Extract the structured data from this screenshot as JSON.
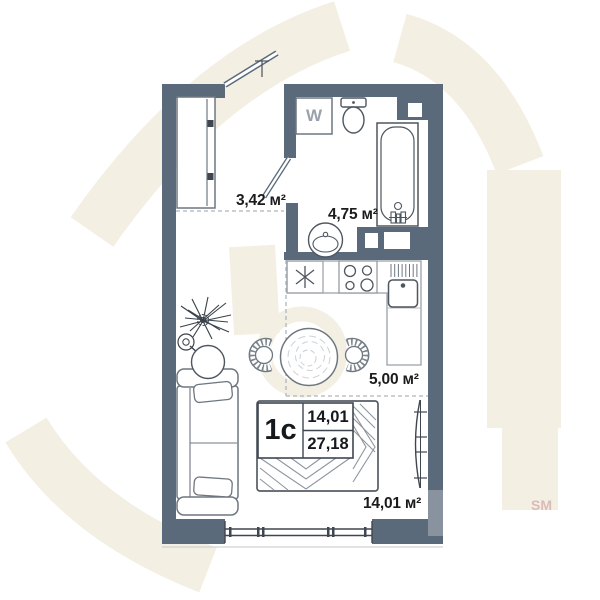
{
  "floorplan": {
    "unit": {
      "type_label": "1с",
      "area_value_top": "14,01",
      "area_value_bottom": "27,18"
    },
    "room_labels": {
      "hallway": "3,42 м²",
      "bathroom": "4,75 м²",
      "kitchen": "5,00 м²",
      "living_room": "14,01 м²"
    },
    "appliances": {
      "washing_machine_label": "W"
    },
    "watermark": {
      "text": "SM"
    },
    "colors": {
      "wall": "#5a6a7b",
      "watermark_beige": "#f4efe3",
      "label_text": "#1b1b1b"
    }
  }
}
